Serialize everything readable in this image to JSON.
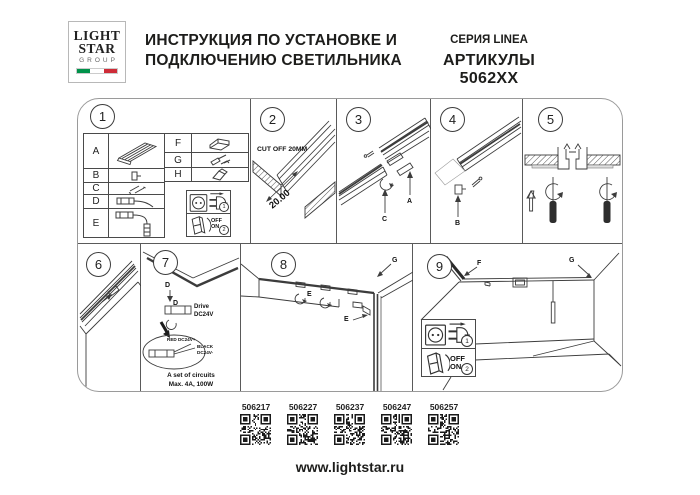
{
  "header": {
    "logo": {
      "line1": "LIGHT",
      "line2": "STAR",
      "line3": "GROUP"
    },
    "title_line1": "ИНСТРУКЦИЯ ПО УСТАНОВКЕ И",
    "title_line2": "ПОДКЛЮЧЕНИЮ СВЕТИЛЬНИКА",
    "series": "СЕРИЯ LINEA",
    "articles": "АРТИКУЛЫ 5062XX"
  },
  "power": {
    "off": "OFF",
    "on": "ON",
    "step1": "1",
    "step2": "2"
  },
  "parts_table": {
    "left": [
      {
        "label": "A",
        "icon": "profile-rail-icon"
      },
      {
        "label": "B",
        "icon": "end-clip-icon"
      },
      {
        "label": "C",
        "icon": "screws-icon"
      },
      {
        "label": "D",
        "icon": "driver-cable-icon"
      },
      {
        "label": "E",
        "icon": "corner-cable-icon"
      }
    ],
    "right": [
      {
        "label": "F",
        "icon": "corner-connector-icon"
      },
      {
        "label": "G",
        "icon": "fastener-set-icon"
      },
      {
        "label": "H",
        "icon": "corner-piece-icon"
      }
    ]
  },
  "panels": {
    "p1": {
      "number": "1"
    },
    "p2": {
      "number": "2",
      "cut_off": "CUT OFF 20MM",
      "dimension": "20.00"
    },
    "p3": {
      "number": "3",
      "label_a": "A",
      "label_c": "C"
    },
    "p4": {
      "number": "4",
      "label_b": "B"
    },
    "p5": {
      "number": "5"
    },
    "p6": {
      "number": "6"
    },
    "p7": {
      "number": "7",
      "label_d1": "D",
      "label_d2": "D",
      "driver_line1": "Drive",
      "driver_line2": "DC24V",
      "wire_red": "RED DC24V+",
      "wire_black_line1": "BLACK",
      "wire_black_line2": "DC24V-",
      "circuits_line1": "A set of circuits",
      "circuits_line2": "Max. 4A, 100W"
    },
    "p8": {
      "number": "8",
      "label_e1": "E",
      "label_e2": "E",
      "label_g": "G"
    },
    "p9": {
      "number": "9",
      "label_f": "F",
      "label_g": "G"
    }
  },
  "footer": {
    "articles": [
      {
        "code": "506217"
      },
      {
        "code": "506227"
      },
      {
        "code": "506237"
      },
      {
        "code": "506247"
      },
      {
        "code": "506257"
      }
    ],
    "url": "www.lightstar.ru"
  },
  "colors": {
    "flag_green": "#00924a",
    "flag_red": "#ce2b37",
    "line_art": "#3c3c3c"
  }
}
